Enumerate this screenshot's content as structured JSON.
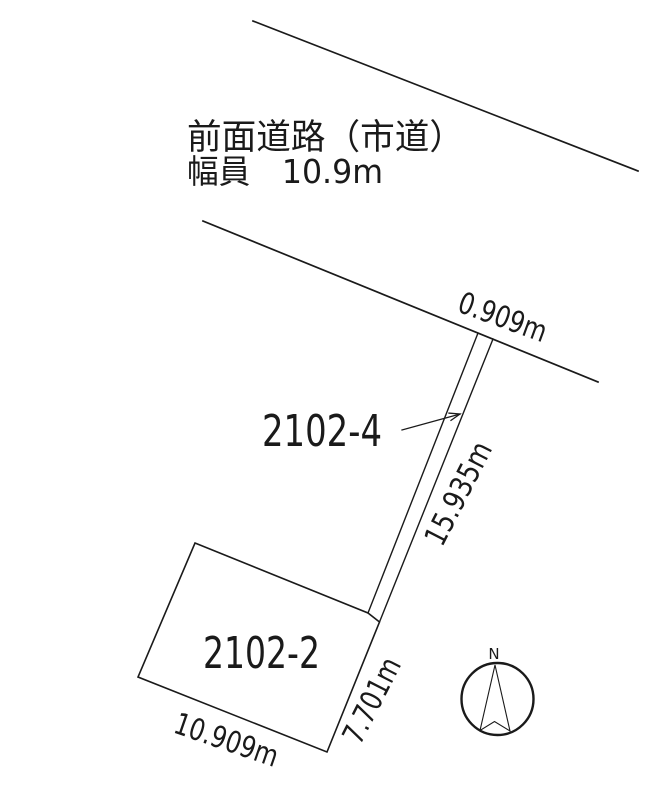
{
  "road": {
    "name_label": "前面道路（市道）",
    "width_label": "幅員　10.9m",
    "frontage_dimension": "0.909m"
  },
  "parcels": {
    "flag_lot_number": "2102-4",
    "flag_lot_length_dimension": "15.935m",
    "main_lot_number": "2102-2",
    "main_lot_right_dimension": "7.701m",
    "main_lot_bottom_dimension": "10.909m"
  },
  "compass": {
    "north_label": "N"
  },
  "colors": {
    "ink": "#1a1a1a",
    "paper": "#ffffff"
  }
}
